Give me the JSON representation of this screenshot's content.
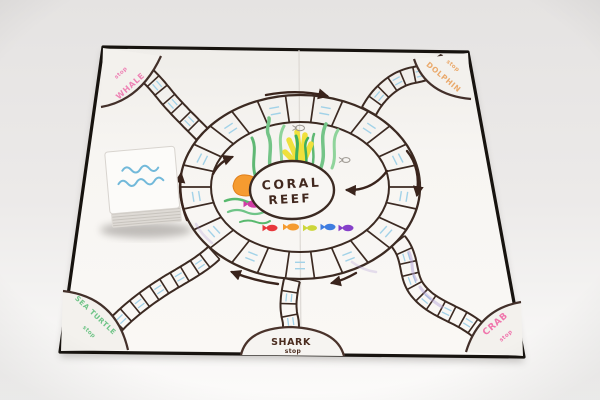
{
  "board": {
    "center": {
      "line1": "CORAL",
      "line2": "REEF",
      "ink_color": "#42281e"
    },
    "stops": {
      "top_left": {
        "label": "WHALE",
        "sub": "stop",
        "color": "#ee82b4"
      },
      "top_right": {
        "label": "DOLPHIN",
        "sub": "stop",
        "color": "#eaa96b"
      },
      "bottom_left": {
        "label": "SEA TURTLE",
        "sub": "stop",
        "color": "#6fc487"
      },
      "bottom_center": {
        "label": "SHARK",
        "sub": "stop",
        "color": "#4b2d20"
      },
      "bottom_right": {
        "label": "CRAB",
        "sub": "stop",
        "color": "#f075ac"
      }
    },
    "track_ink_color": "#3c2a22",
    "water_hatch_color": "#a2d2e8",
    "arrow_direction": "clockwise",
    "reef_fish_colors": [
      "#e8383d",
      "#f59b30",
      "#cdd63a",
      "#3f7de0",
      "#8640c9"
    ],
    "center_fish_color": "#d13ea6",
    "seaweed_color": "#74c487",
    "anemone_color": "#f0e03c",
    "coral_color": "#f59b30"
  },
  "card_deck": {
    "decoration": "two blue wavy water lines",
    "wave_color": "#72b9da",
    "card_color": "#fcfbf9"
  }
}
